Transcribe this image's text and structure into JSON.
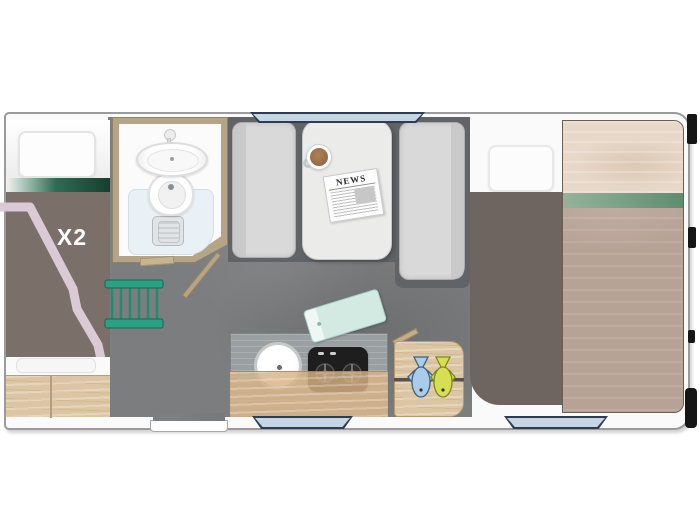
{
  "plan": {
    "bunk_label": "X2",
    "newspaper_title": "NEWS"
  },
  "items": [
    "over-cab-bunk-bed",
    "bunk-ladder",
    "bathroom",
    "shower-tray",
    "washbasin",
    "toilet",
    "shower-drain",
    "bathroom-door",
    "entry-door-opening",
    "dinette-left-bench",
    "dinette-table",
    "dinette-right-bench",
    "coffee-cup",
    "newspaper",
    "kitchen-counter",
    "kitchen-sink",
    "stove-two-burner",
    "cutting-board",
    "prep-board-with-fish",
    "knife",
    "rear-bed",
    "rear-bed-wood-panel",
    "storage-drawers",
    "window-top",
    "window-bottom-left",
    "window-bottom-right",
    "rear-exterior-trim"
  ],
  "colors": {
    "floor": "#7b7d7e",
    "platform_gray": "#616467",
    "cushion_gray": "#d9d9d9",
    "table_gray": "#ebebea",
    "blanket_brown": "#7b6f6a",
    "mattress_brown": "#6f6560",
    "pink_trim": "#d9cad6",
    "stripe_green_dark": "#16402f",
    "stripe_green_mid": "#2e6b54",
    "ladder_green": "#2aa184",
    "frame_wood": "#b5a486",
    "cabinet_wood": "#dcc5a3",
    "counter_wood_gray": "#9aa0a1",
    "counter_flap_tan": "#d8b285",
    "panel_wood_light": "#e7d8c8",
    "panel_wood_dark": "#b7a396",
    "panel_stripe_green": "#4e8868",
    "shower_blue": "#e9f1f6",
    "window_blue": "#c7d6e4",
    "window_frame": "#2e3d52",
    "stove_black": "#1e1e1e",
    "mint_board": "#d3eae3",
    "fish_blue": "#a9cde8",
    "fish_yellow": "#d6df52",
    "white_soft": "#fafafa"
  }
}
